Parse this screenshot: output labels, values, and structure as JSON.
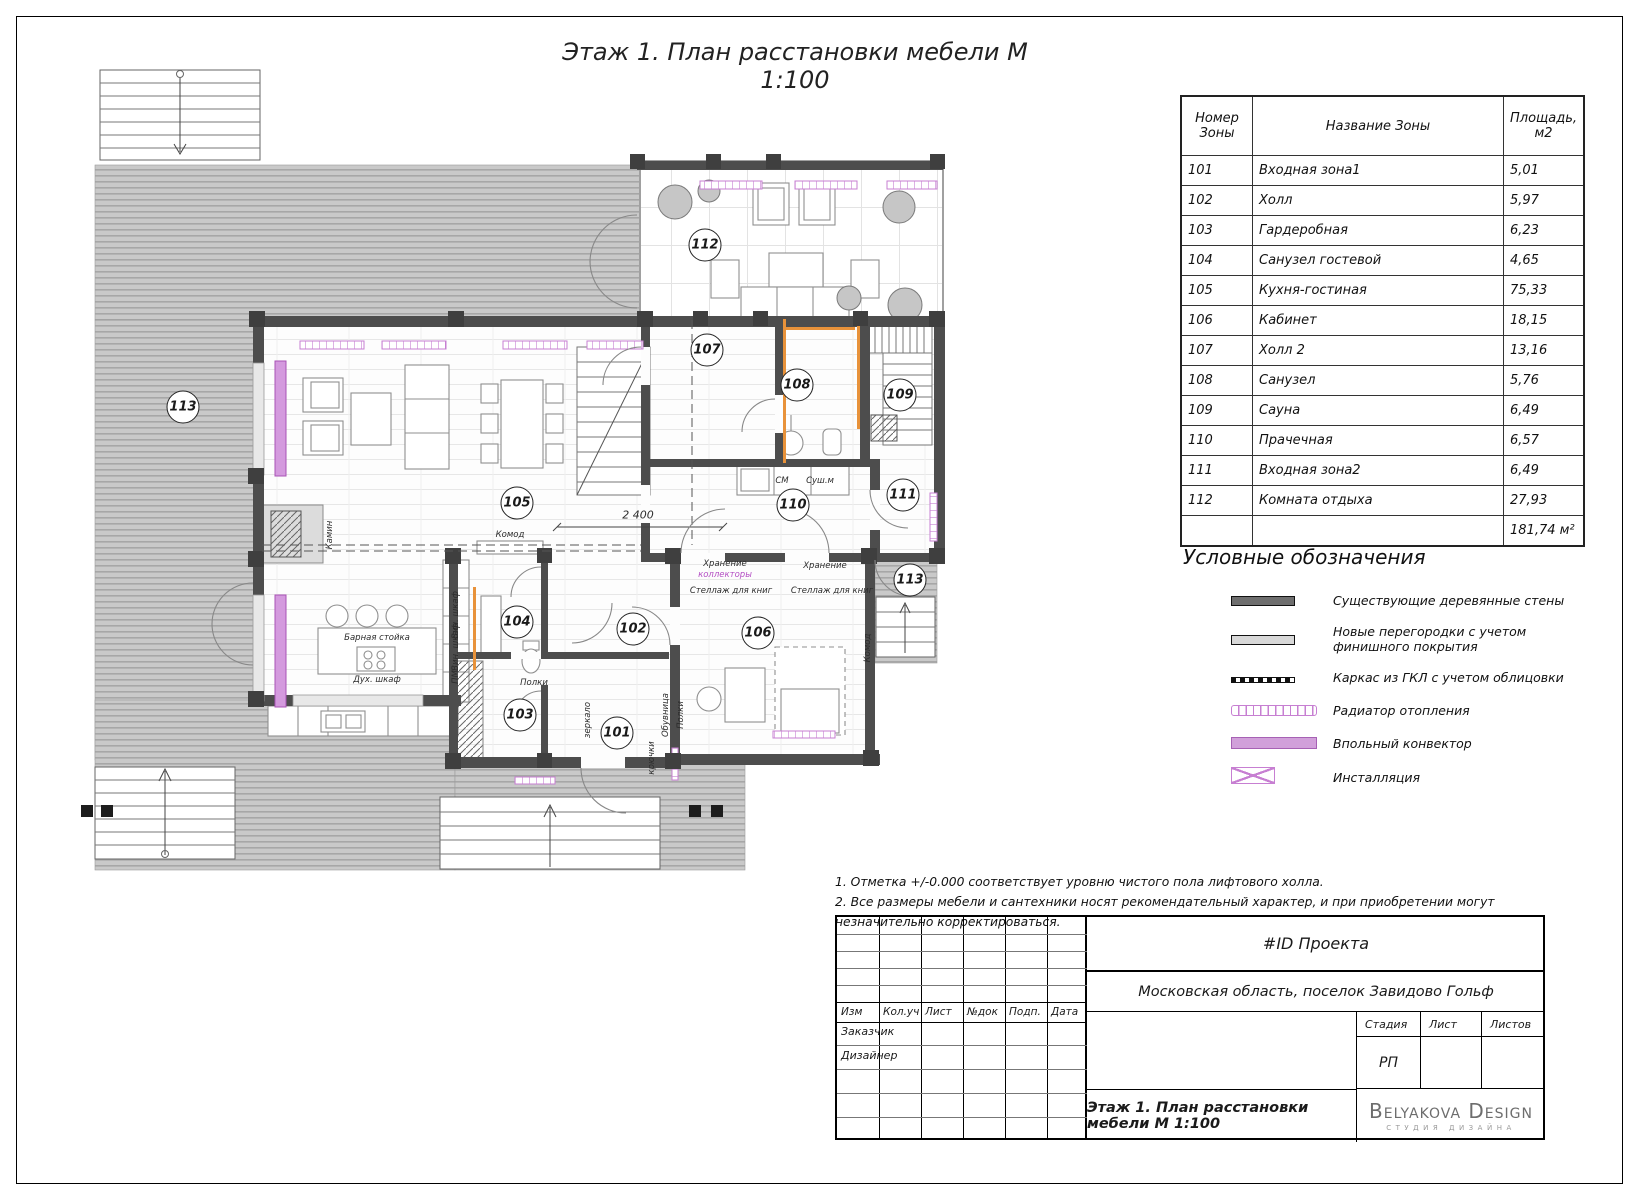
{
  "sheet": {
    "title": "Этаж 1. План расстановки мебели М 1:100"
  },
  "zones_table": {
    "headers": {
      "num": "Номер\nЗоны",
      "name": "Название Зоны",
      "area": "Площадь,\nм2"
    },
    "rows": [
      [
        "101",
        "Входная зона1",
        "5,01"
      ],
      [
        "102",
        "Холл",
        "5,97"
      ],
      [
        "103",
        "Гардеробная",
        "6,23"
      ],
      [
        "104",
        "Санузел гостевой",
        "4,65"
      ],
      [
        "105",
        "Кухня-гостиная",
        "75,33"
      ],
      [
        "106",
        "Кабинет",
        "18,15"
      ],
      [
        "107",
        "Холл 2",
        "13,16"
      ],
      [
        "108",
        "Санузел",
        "5,76"
      ],
      [
        "109",
        "Сауна",
        "6,49"
      ],
      [
        "110",
        "Прачечная",
        "6,57"
      ],
      [
        "111",
        "Входная зона2",
        "6,49"
      ],
      [
        "112",
        "Комната отдыха",
        "27,93"
      ]
    ],
    "total": "181,74 м²"
  },
  "legend": {
    "title": "Условные обозначения",
    "items": [
      {
        "symbol": "existing-wall",
        "label": "Существующие деревянные стены"
      },
      {
        "symbol": "new-partition",
        "label": "Новые перегородки с учетом финишного покрытия"
      },
      {
        "symbol": "gkl-frame",
        "label": "Каркас из ГКЛ с учетом облицовки"
      },
      {
        "symbol": "radiator",
        "label": "Радиатор отопления"
      },
      {
        "symbol": "floor-convector",
        "label": "Впольный конвектор"
      },
      {
        "symbol": "installation",
        "label": "Инсталляция"
      }
    ]
  },
  "notes": [
    "1. Отметка +/-0.000 соответствует уровню чистого пола лифтового холла.",
    "2. Все размеры мебели и сантехники носят рекомендательный характер, и при приобретении могут незначительно корректироваться."
  ],
  "title_block": {
    "project_id": "#ID Проекта",
    "address": "Московская область, поселок Завидово Гольф",
    "rev_headers": [
      "Изм",
      "Кол.уч",
      "Лист",
      "№док",
      "Подп.",
      "Дата"
    ],
    "customer_label": "Заказчик",
    "designer_label": "Дизайнер",
    "stage_label": "Стадия",
    "sheet_label": "Лист",
    "sheets_label": "Листов",
    "stage_value": "РП",
    "drawing_title": "Этаж 1. План расстановки мебели М 1:100",
    "brand_name": "Belyakova Design",
    "brand_subtitle": "студия дизайна"
  },
  "plan": {
    "rooms": [
      {
        "id": "101",
        "x": 592,
        "y": 678
      },
      {
        "id": "102",
        "x": 608,
        "y": 574
      },
      {
        "id": "103",
        "x": 495,
        "y": 660
      },
      {
        "id": "104",
        "x": 492,
        "y": 567
      },
      {
        "id": "105",
        "x": 492,
        "y": 448
      },
      {
        "id": "106",
        "x": 733,
        "y": 578
      },
      {
        "id": "107",
        "x": 682,
        "y": 295
      },
      {
        "id": "108",
        "x": 772,
        "y": 330
      },
      {
        "id": "109",
        "x": 875,
        "y": 340
      },
      {
        "id": "110",
        "x": 768,
        "y": 450
      },
      {
        "id": "111",
        "x": 878,
        "y": 440
      },
      {
        "id": "112",
        "x": 680,
        "y": 190
      },
      {
        "id": "113",
        "x": 158,
        "y": 352
      },
      {
        "id": "113",
        "x": 885,
        "y": 525
      }
    ],
    "labels": [
      {
        "t": "Барная стойка",
        "x": 352,
        "y": 583
      },
      {
        "t": "Дух. шкаф",
        "x": 352,
        "y": 625
      },
      {
        "t": "Камин",
        "x": 305,
        "y": 480,
        "r": 1
      },
      {
        "t": "Комод",
        "x": 485,
        "y": 480
      },
      {
        "t": "Комод",
        "x": 843,
        "y": 593,
        "r": 1
      },
      {
        "t": "Полки",
        "x": 509,
        "y": 628
      },
      {
        "t": "Хранение",
        "x": 700,
        "y": 509
      },
      {
        "t": "коллекторы",
        "x": 700,
        "y": 520,
        "pink": 1
      },
      {
        "t": "Хранение",
        "x": 800,
        "y": 511
      },
      {
        "t": "Стеллаж для книг",
        "x": 706,
        "y": 536
      },
      {
        "t": "Стеллаж для книг",
        "x": 807,
        "y": 536
      },
      {
        "t": "СМ",
        "x": 757,
        "y": 426
      },
      {
        "t": "Суш.м",
        "x": 795,
        "y": 426
      },
      {
        "t": "Вин. шкаф",
        "x": 431,
        "y": 560,
        "r": 1
      },
      {
        "t": "Вин. шкаф",
        "x": 431,
        "y": 592,
        "r": 1
      },
      {
        "t": "ПМ",
        "x": 431,
        "y": 622,
        "r": 1
      },
      {
        "t": "зеркало",
        "x": 563,
        "y": 665,
        "r": 1
      },
      {
        "t": "Обувница",
        "x": 641,
        "y": 660,
        "r": 1
      },
      {
        "t": "Полки",
        "x": 656,
        "y": 660,
        "r": 1
      },
      {
        "t": "крючки",
        "x": 627,
        "y": 703,
        "r": 1
      },
      {
        "t": "2 400",
        "x": 613,
        "y": 460,
        "dim": 1
      }
    ]
  },
  "colors": {
    "pink": "#c77fd2",
    "wall": "#4d4d4d",
    "orange": "#e8923a"
  }
}
